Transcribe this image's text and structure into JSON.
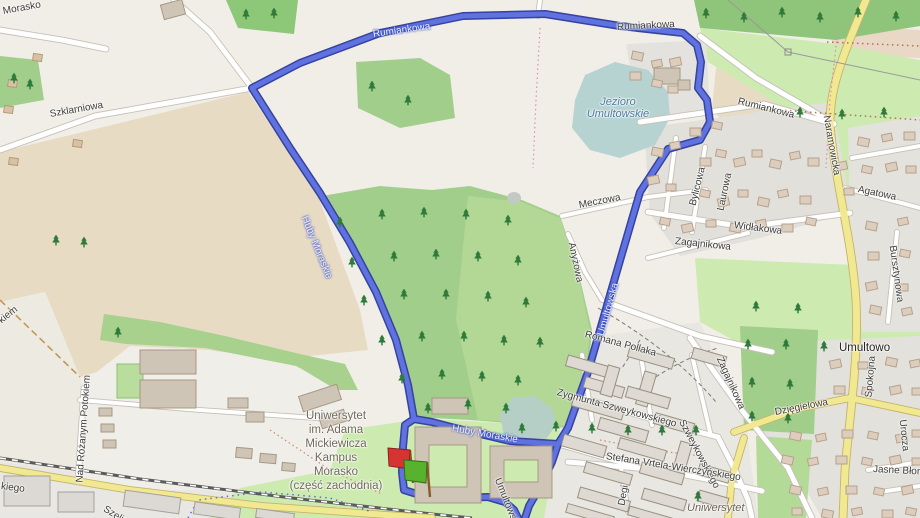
{
  "map_view": {
    "description": "OpenStreetMap-style map of Morasko / Umultowo district in Poznań with a running route loop around the UAM Morasko campus and Jezioro Umultowskie",
    "route": {
      "color_fill": "#5f72e0",
      "color_casing": "#35429f",
      "start_marker": "red flag",
      "finish_marker": "green flag"
    }
  },
  "colors": {
    "background": "#f1eee8",
    "farmland_tan": "#e7dbc4",
    "dirt_pink": "#ead8c6",
    "forest_green": "#a2ce8c",
    "grass_light": "#cdebb0",
    "residential_gray": "#e2e0db",
    "water": "#b6d3d2",
    "road_white": "#fefefe",
    "road_yellow": "#f1e992",
    "railway": "#5b5b5b",
    "route_blue": "#5f72e0",
    "flag_start": "#d63333",
    "flag_finish": "#57b32e"
  },
  "icons": {
    "tree": "conifer-tree-icon",
    "start_flag": "red-flag-icon",
    "finish_flag": "green-flag-icon",
    "power_pole": "power-pole-icon"
  },
  "labels": [
    {
      "id": "morasko",
      "text": "Morasko",
      "x": 3,
      "y": 6,
      "rot": -10,
      "cls": "street"
    },
    {
      "id": "szklarniowa",
      "text": "Szklarniowa",
      "x": 50,
      "y": 109,
      "rot": -10,
      "cls": "street"
    },
    {
      "id": "rumiankowa-route-nw",
      "text": "Rumiankowa",
      "x": 373,
      "y": 29,
      "rot": -8,
      "cls": "onroute"
    },
    {
      "id": "rumiankowa-route-n",
      "text": "Rumiankowa",
      "x": 617,
      "y": 22,
      "rot": -3,
      "cls": "street"
    },
    {
      "id": "rumiankowa-road",
      "text": "Rumiankowa",
      "x": 738,
      "y": 96,
      "rot": 14,
      "cls": "street"
    },
    {
      "id": "naramowicka",
      "text": "Naramowicka",
      "x": 826,
      "y": 110,
      "rot": 80,
      "cls": "street"
    },
    {
      "id": "jezioro-umultowskie",
      "text": "Jezioro\nUmultowskie",
      "x": 570,
      "y": 96,
      "rot": 0,
      "cls": "water",
      "w": 96
    },
    {
      "id": "bylicowa",
      "text": "Bylicowa",
      "x": 693,
      "y": 200,
      "rot": -76,
      "cls": "street"
    },
    {
      "id": "laurowa",
      "text": "Laurowa",
      "x": 721,
      "y": 205,
      "rot": -78,
      "cls": "street"
    },
    {
      "id": "meczowa",
      "text": "Meczowa",
      "x": 579,
      "y": 200,
      "rot": -11,
      "cls": "street"
    },
    {
      "id": "anyzowa",
      "text": "Anyżowa",
      "x": 571,
      "y": 237,
      "rot": 78,
      "cls": "street"
    },
    {
      "id": "widlakowa",
      "text": "Widłakowa",
      "x": 734,
      "y": 220,
      "rot": 7,
      "cls": "street"
    },
    {
      "id": "zagajnikowa-n",
      "text": "Zagajnikowa",
      "x": 675,
      "y": 236,
      "rot": 6,
      "cls": "street"
    },
    {
      "id": "agatowa",
      "text": "Agatowa",
      "x": 858,
      "y": 184,
      "rot": 12,
      "cls": "street"
    },
    {
      "id": "bursztynowa",
      "text": "Bursztynowa",
      "x": 892,
      "y": 240,
      "rot": 82,
      "cls": "street"
    },
    {
      "id": "umultowska-route",
      "text": "Umultowska",
      "x": 601,
      "y": 330,
      "rot": -74,
      "cls": "onroute"
    },
    {
      "id": "huby-moraskie-n",
      "text": "Huby Moraskie",
      "x": 304,
      "y": 211,
      "rot": 68,
      "cls": "onroute"
    },
    {
      "id": "huby-moraskie-s",
      "text": "Huby Moraskie",
      "x": 452,
      "y": 423,
      "rot": 10,
      "cls": "onroute"
    },
    {
      "id": "romana-pollaka",
      "text": "Romana Pollaka",
      "x": 585,
      "y": 329,
      "rot": 15,
      "cls": "street"
    },
    {
      "id": "zygmunta-szweykowskiego",
      "text": "Zygmunta Szweykowskiego",
      "x": 557,
      "y": 387,
      "rot": 15,
      "cls": "street"
    },
    {
      "id": "szweykowskiego",
      "text": "Szweykowskiego",
      "x": 681,
      "y": 415,
      "rot": 62,
      "cls": "street"
    },
    {
      "id": "zagajnikowa-se",
      "text": "Zagajnikowa",
      "x": 719,
      "y": 352,
      "rot": 66,
      "cls": "street"
    },
    {
      "id": "stefana-vrtela",
      "text": "Stefana Vrtela-Wierczyńskiego",
      "x": 606,
      "y": 451,
      "rot": 9,
      "cls": "street"
    },
    {
      "id": "degi",
      "text": "Degi",
      "x": 622,
      "y": 500,
      "rot": -80,
      "cls": "street"
    },
    {
      "id": "umultowo",
      "text": "Umultowo",
      "x": 839,
      "y": 342,
      "rot": 0,
      "cls": "place"
    },
    {
      "id": "spokojna",
      "text": "Spokojna",
      "x": 869,
      "y": 392,
      "rot": -85,
      "cls": "street"
    },
    {
      "id": "dziegielowa",
      "text": "Dzięgielowa",
      "x": 775,
      "y": 407,
      "rot": -11,
      "cls": "street"
    },
    {
      "id": "urocza",
      "text": "Urocza",
      "x": 902,
      "y": 414,
      "rot": 84,
      "cls": "street"
    },
    {
      "id": "jasne-blonie",
      "text": "Jasne Błonie",
      "x": 873,
      "y": 464,
      "rot": 3,
      "cls": "street"
    },
    {
      "id": "nad-rozanym-potokiem",
      "text": "Nad Różanym Potokiem",
      "x": 80,
      "y": 477,
      "rot": -86,
      "cls": "street"
    },
    {
      "id": "kiem-fragment",
      "text": "kiem",
      "x": 0,
      "y": 316,
      "rot": -38,
      "cls": "street"
    },
    {
      "id": "kiego-fragment",
      "text": "kiego",
      "x": 1,
      "y": 481,
      "rot": 7,
      "cls": "street"
    },
    {
      "id": "szelig-fragment",
      "text": "Szelig",
      "x": 104,
      "y": 503,
      "rot": 32,
      "cls": "street"
    },
    {
      "id": "umultowska-street-s",
      "text": "Umultowska",
      "x": 497,
      "y": 473,
      "rot": 68,
      "cls": "street"
    },
    {
      "id": "campus-morasko",
      "text": "Uniwersytet\nim. Adama\nMickiewicza\nKampus\nMorasko\n(część zachodnia)",
      "x": 262,
      "y": 409,
      "rot": 0,
      "cls": "campus",
      "w": 148
    },
    {
      "id": "uniwersytet-area",
      "text": "Uniwersytet",
      "x": 687,
      "y": 502,
      "rot": 0,
      "cls": "area"
    }
  ]
}
